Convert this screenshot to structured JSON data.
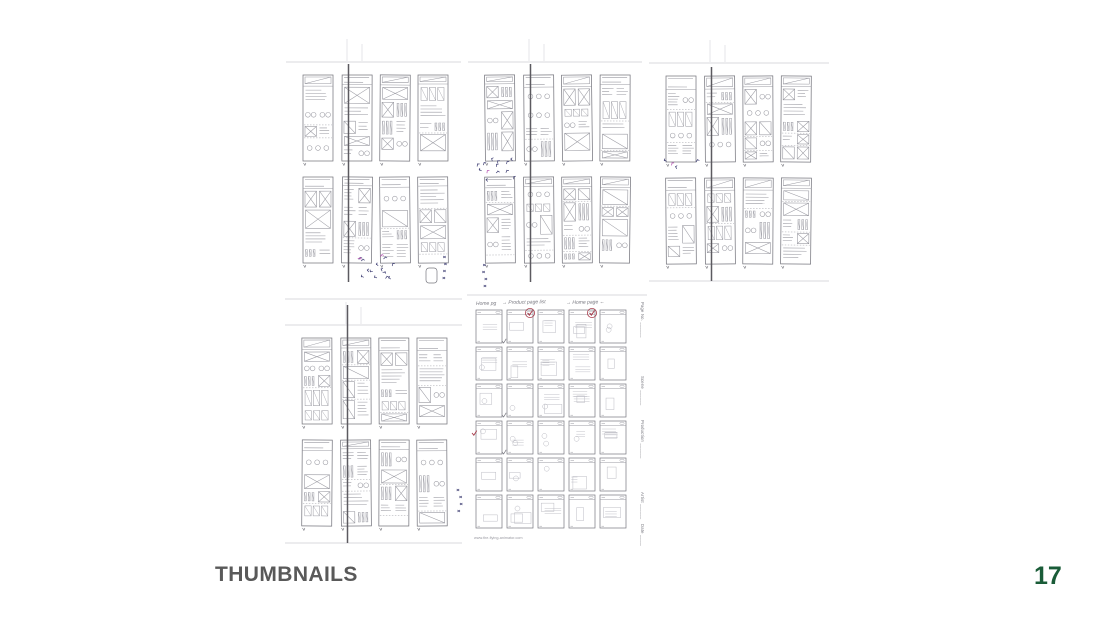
{
  "slide": {
    "title": "THUMBNAILS",
    "page_number": "17",
    "colors": {
      "background": "#ffffff",
      "title": "#595959",
      "page_number": "#1a5c38",
      "pencil": "#9a9aa2",
      "pencil_dark": "#77777f",
      "pencil_faint": "#bcbcc4",
      "ruled": "#d9d9de",
      "fold_line": "#5c5a60",
      "ink_navy": "#3d3d72",
      "ink_magenta": "#b44fb0",
      "check_red": "#a83a4a"
    },
    "sheets": [
      {
        "id": "sheet-1",
        "kind": "page-spread-sketches",
        "description": "scanned pencil sheet: two rows of four tall page-layout thumbnails with dark center fold line, blue/magenta ink scribbles below",
        "rows": 2,
        "cols": 4,
        "seed": 11,
        "fold_line": true,
        "fold_from": 34,
        "ink_cluster": {
          "x": 92,
          "y": 236,
          "count": 15
        },
        "side_marks": {
          "x": 158,
          "y": 226
        },
        "doodle": true
      },
      {
        "id": "sheet-2",
        "kind": "page-spread-sketches",
        "description": "scanned pencil sheet: two rows of four tall page-layout thumbnails with circle motifs, fold line, ink scribbles at left",
        "rows": 2,
        "cols": 4,
        "seed": 23,
        "fold_line": true,
        "fold_from": 34,
        "ink_cluster": {
          "x": 28,
          "y": 140,
          "count": 13
        },
        "side_marks": {
          "x": 16,
          "y": 234
        }
      },
      {
        "id": "sheet-3",
        "kind": "page-spread-sketches",
        "description": "scanned pencil sheet: two rows of four tall page-layout thumbnails, ruled lines top and bottom, fold line",
        "rows": 2,
        "cols": 4,
        "seed": 37,
        "fold_line": true,
        "fold_from": 36,
        "bottom_rule": true,
        "ink_cluster": {
          "x": 32,
          "y": 138,
          "count": 4
        }
      },
      {
        "id": "sheet-4",
        "kind": "page-spread-sketches",
        "description": "scanned pencil sheet: two rows of four tall page-layout thumbnails, full-height fold line, blue ink tally marks at right",
        "rows": 2,
        "cols": 4,
        "seed": 49,
        "fold_line": true,
        "fold_from": 12,
        "top_rule": true,
        "bottom_rule": true,
        "side_marks": {
          "x": 174,
          "y": 196
        }
      },
      {
        "id": "sheet-5",
        "kind": "storyboard-template",
        "description": "printed storyboard template sheet: six rows by five columns of small phone-screen frames with pencil sketches and red circled checkmarks",
        "rows": 6,
        "cols": 5,
        "seed": 99,
        "handwritten_titles": [
          "Home pg",
          "→ Product page list",
          "→ Home page ←"
        ],
        "side_labels": [
          "Page No.",
          "Scene",
          "Production",
          "Artist",
          "Date"
        ],
        "footer_url": "www.the-flying-animator.com",
        "red_checks": [
          [
            0,
            1
          ],
          [
            0,
            3
          ]
        ],
        "red_plain_checks": [
          [
            3,
            0
          ]
        ],
        "pencil_checks": [
          [
            0,
            1
          ],
          [
            2,
            1
          ],
          [
            3,
            1
          ]
        ]
      }
    ]
  }
}
